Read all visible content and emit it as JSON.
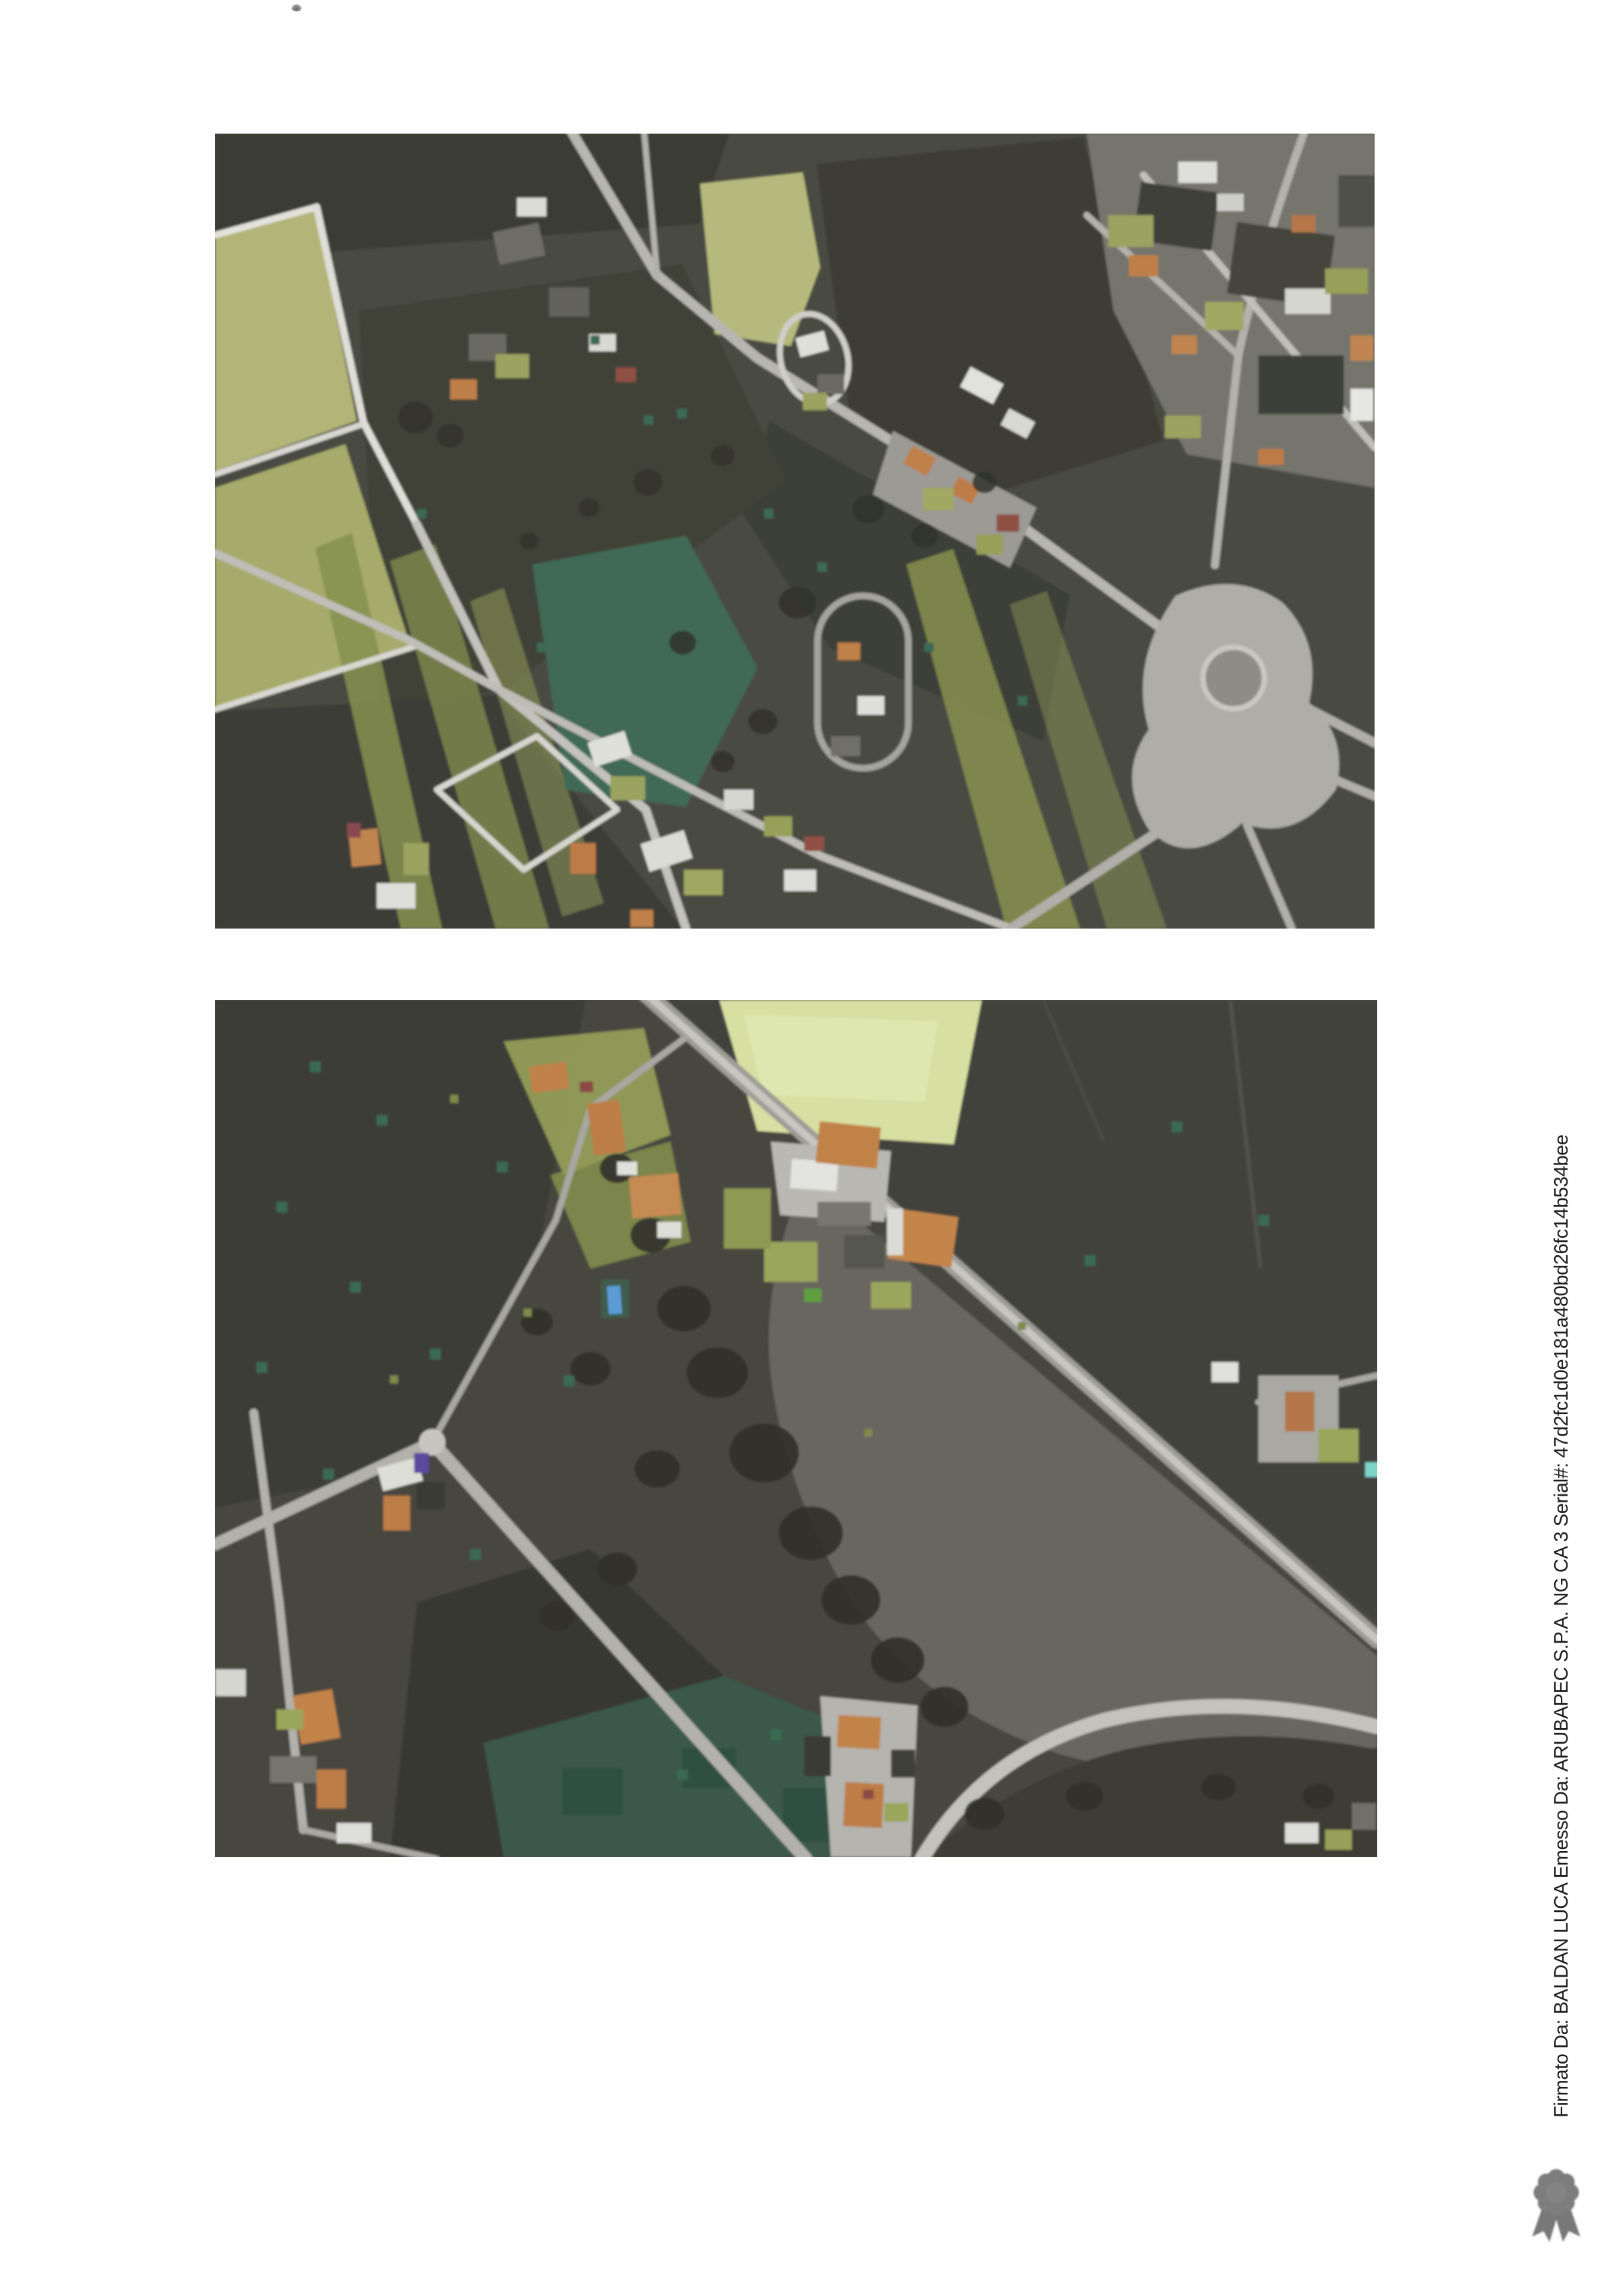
{
  "signature": {
    "text": "Firmato Da: BALDAN LUCA Emesso Da: ARUBAPEC S.P.A. NG CA 3 Serial#: 47d2fc1d0e181a480bd26fc14b534bee",
    "seal_icon": "ribbon-rosette-icon",
    "text_color": "#1c1c1c",
    "seal_color": "#7d7d7d"
  },
  "photos": {
    "top": {
      "name": "aerial-photo-top"
    },
    "bottom": {
      "name": "aerial-photo-bottom"
    }
  },
  "palette": {
    "page_background": "#fefefe",
    "field_dark": "#46473f",
    "field_olive": "#a9ac6d",
    "field_bright_green": "#d7e0a2",
    "field_gray": "#67665f",
    "field_teal": "#3e6953",
    "road_light": "#c7c6c0",
    "roof_orange": "#c0814a",
    "roof_dark_red": "#8a4a44",
    "pool_blue": "#5c9bd6"
  }
}
